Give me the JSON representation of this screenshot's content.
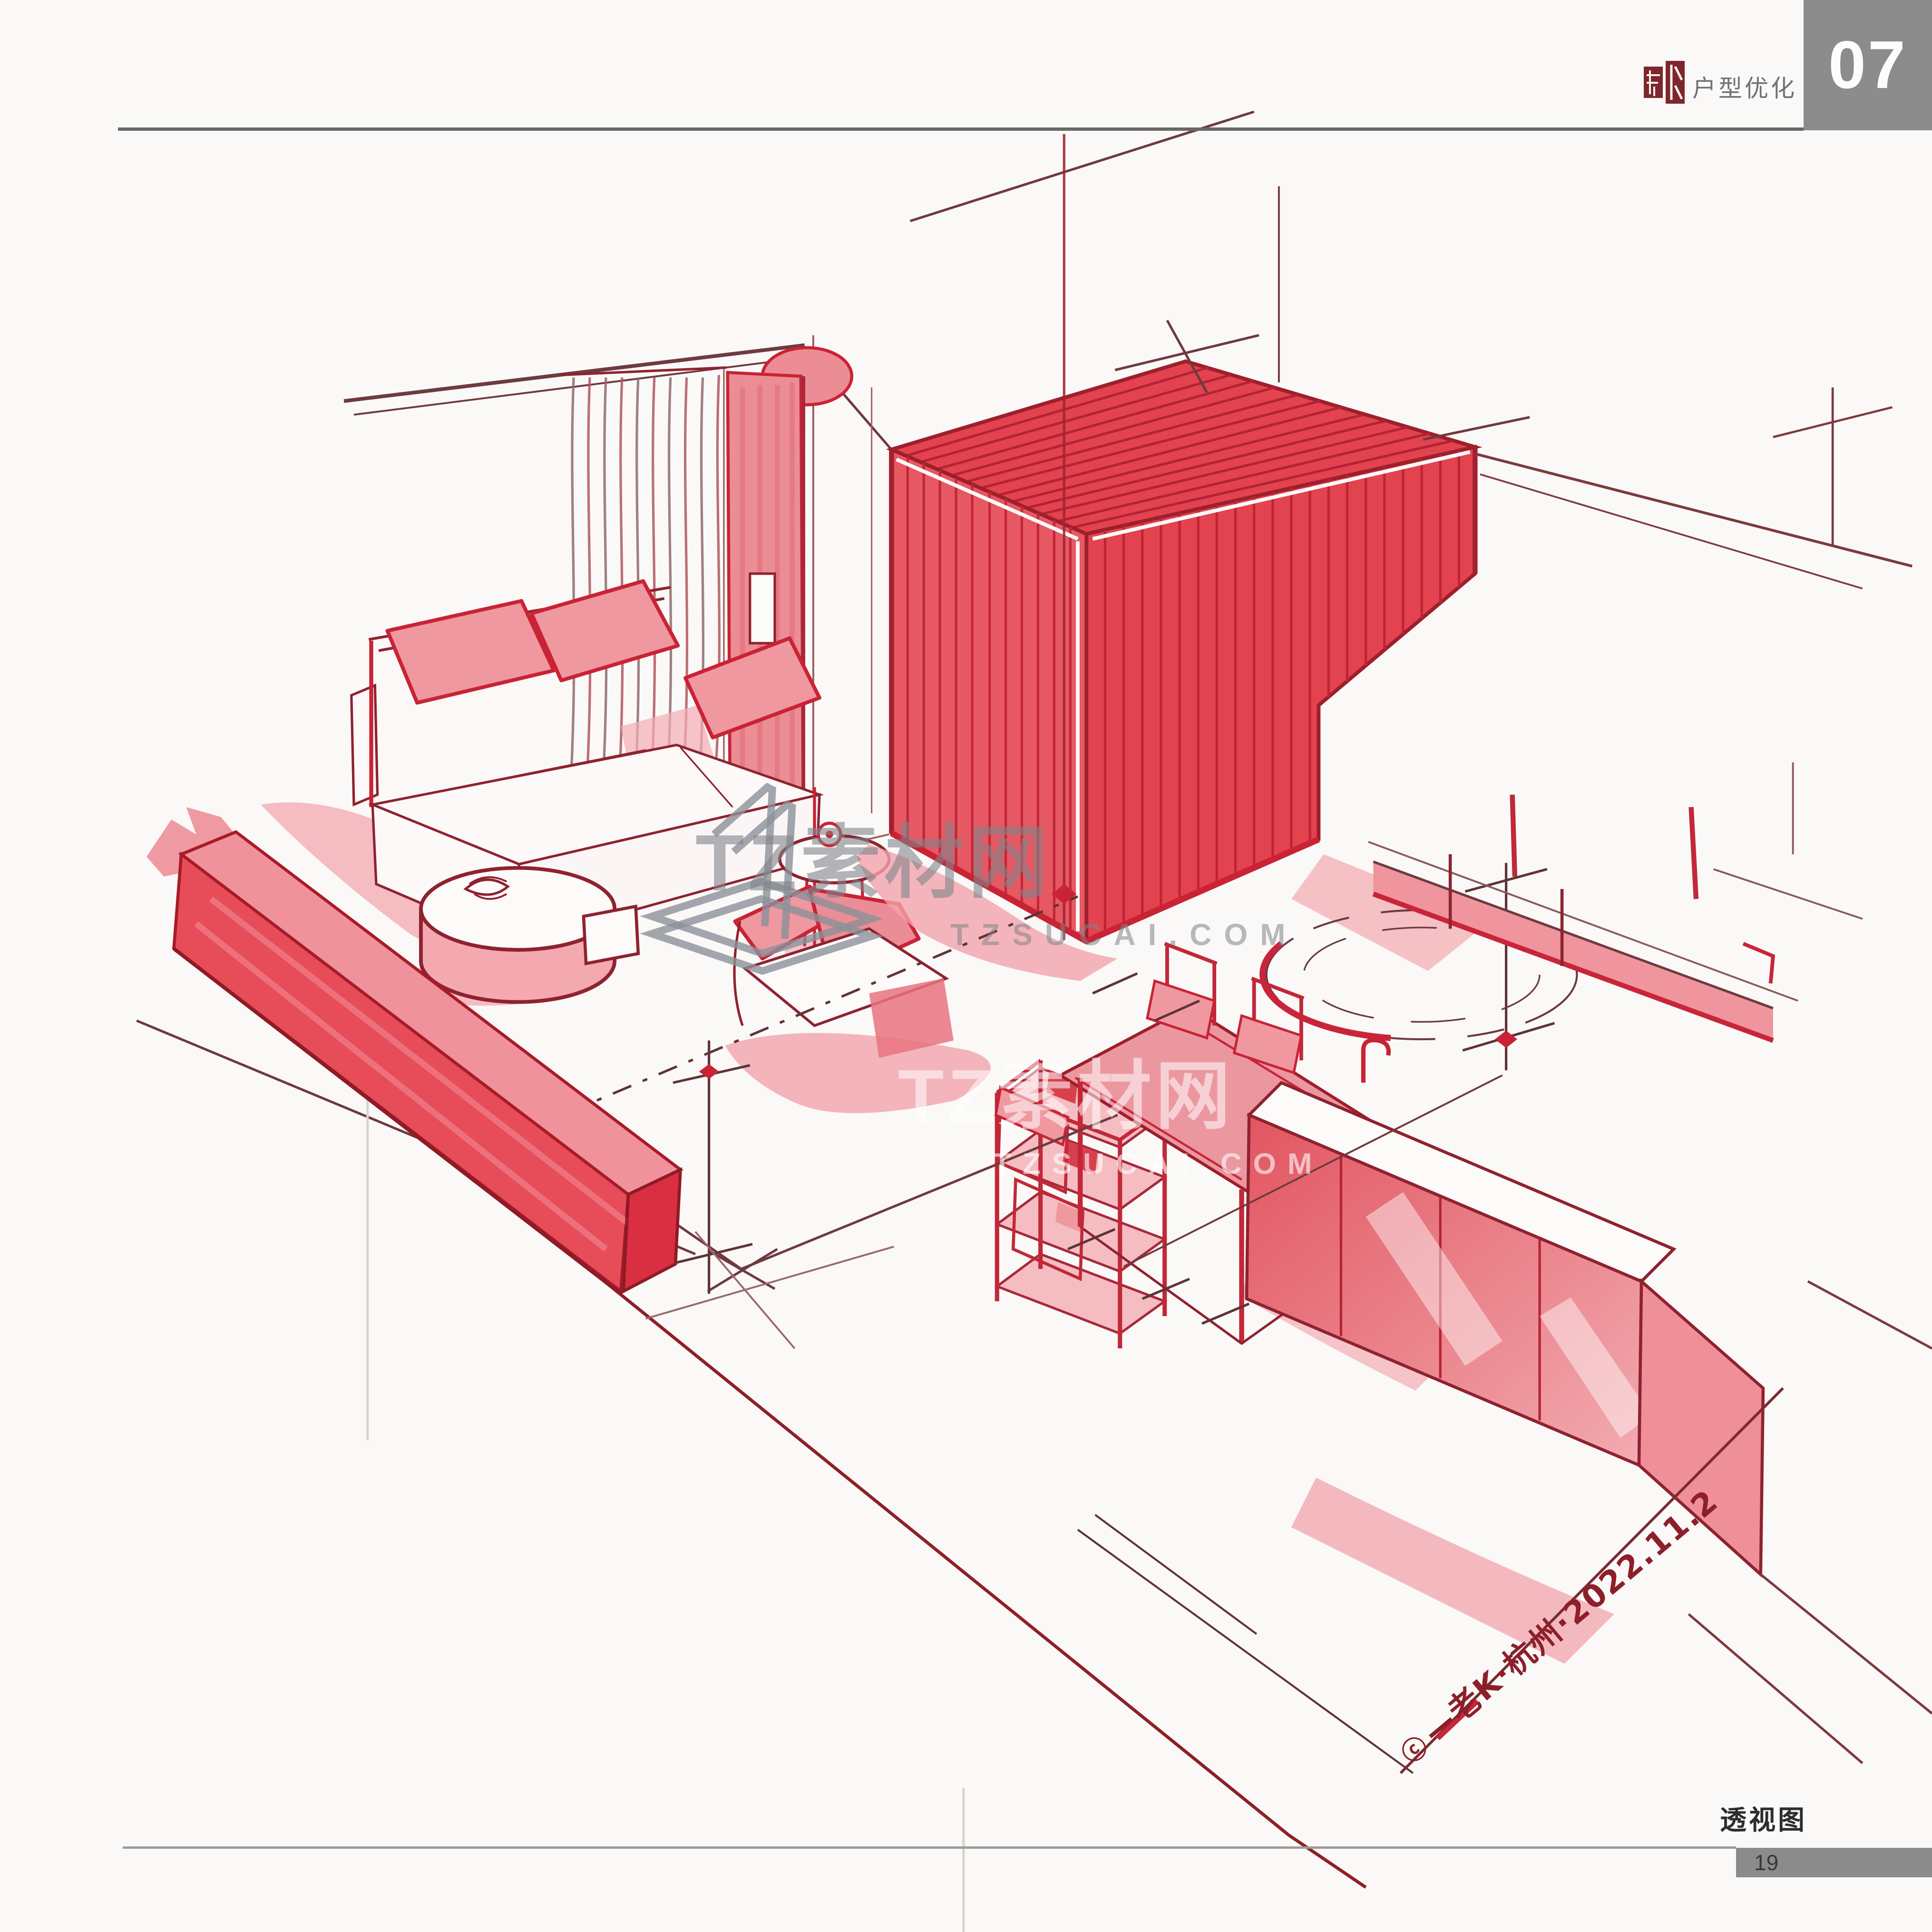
{
  "header": {
    "brand_label": "户型优化",
    "chapter_number": "07"
  },
  "footer": {
    "caption": "透视图",
    "page_number": "19"
  },
  "watermark": {
    "primary": {
      "title": "TZ素材网",
      "domain": "TZSUCAI.COM"
    },
    "secondary": {
      "title": "TZ素材网",
      "domain": "TZSUCAI.COM"
    }
  },
  "signature": {
    "copyright_symbol": "ⓒ",
    "text": "—老K·杭州·2022.11.2"
  },
  "palette": {
    "ink_dark_red": "#8f2230",
    "accent_crimson": "#c92335",
    "fill_red": "#e65a64",
    "fill_pink": "#f0989f",
    "seal_red": "#7e262c",
    "header_bar_gray": "#8c8c8c",
    "watermark_gray": "#9aa0a6"
  }
}
